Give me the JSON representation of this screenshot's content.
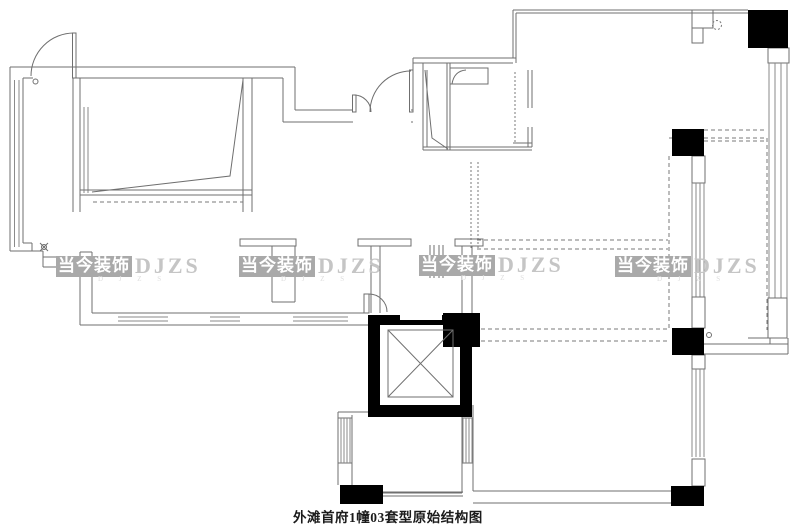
{
  "drawing": {
    "caption": "外滩首府1幢03套型原始结构图",
    "type_label": "original-structure-floor-plan"
  },
  "watermark": {
    "cn": "当今装饰",
    "en": "DJZS",
    "sub": "D J Z S"
  },
  "colors": {
    "background": "#ffffff",
    "wall_line": "#6f6f6f",
    "solid_fill": "#000000",
    "watermark_box": "#a9a9a9",
    "watermark_cn_text": "#ffffff",
    "watermark_latin_text": "#c5c5c5",
    "caption_text": "#1b1b1b"
  }
}
